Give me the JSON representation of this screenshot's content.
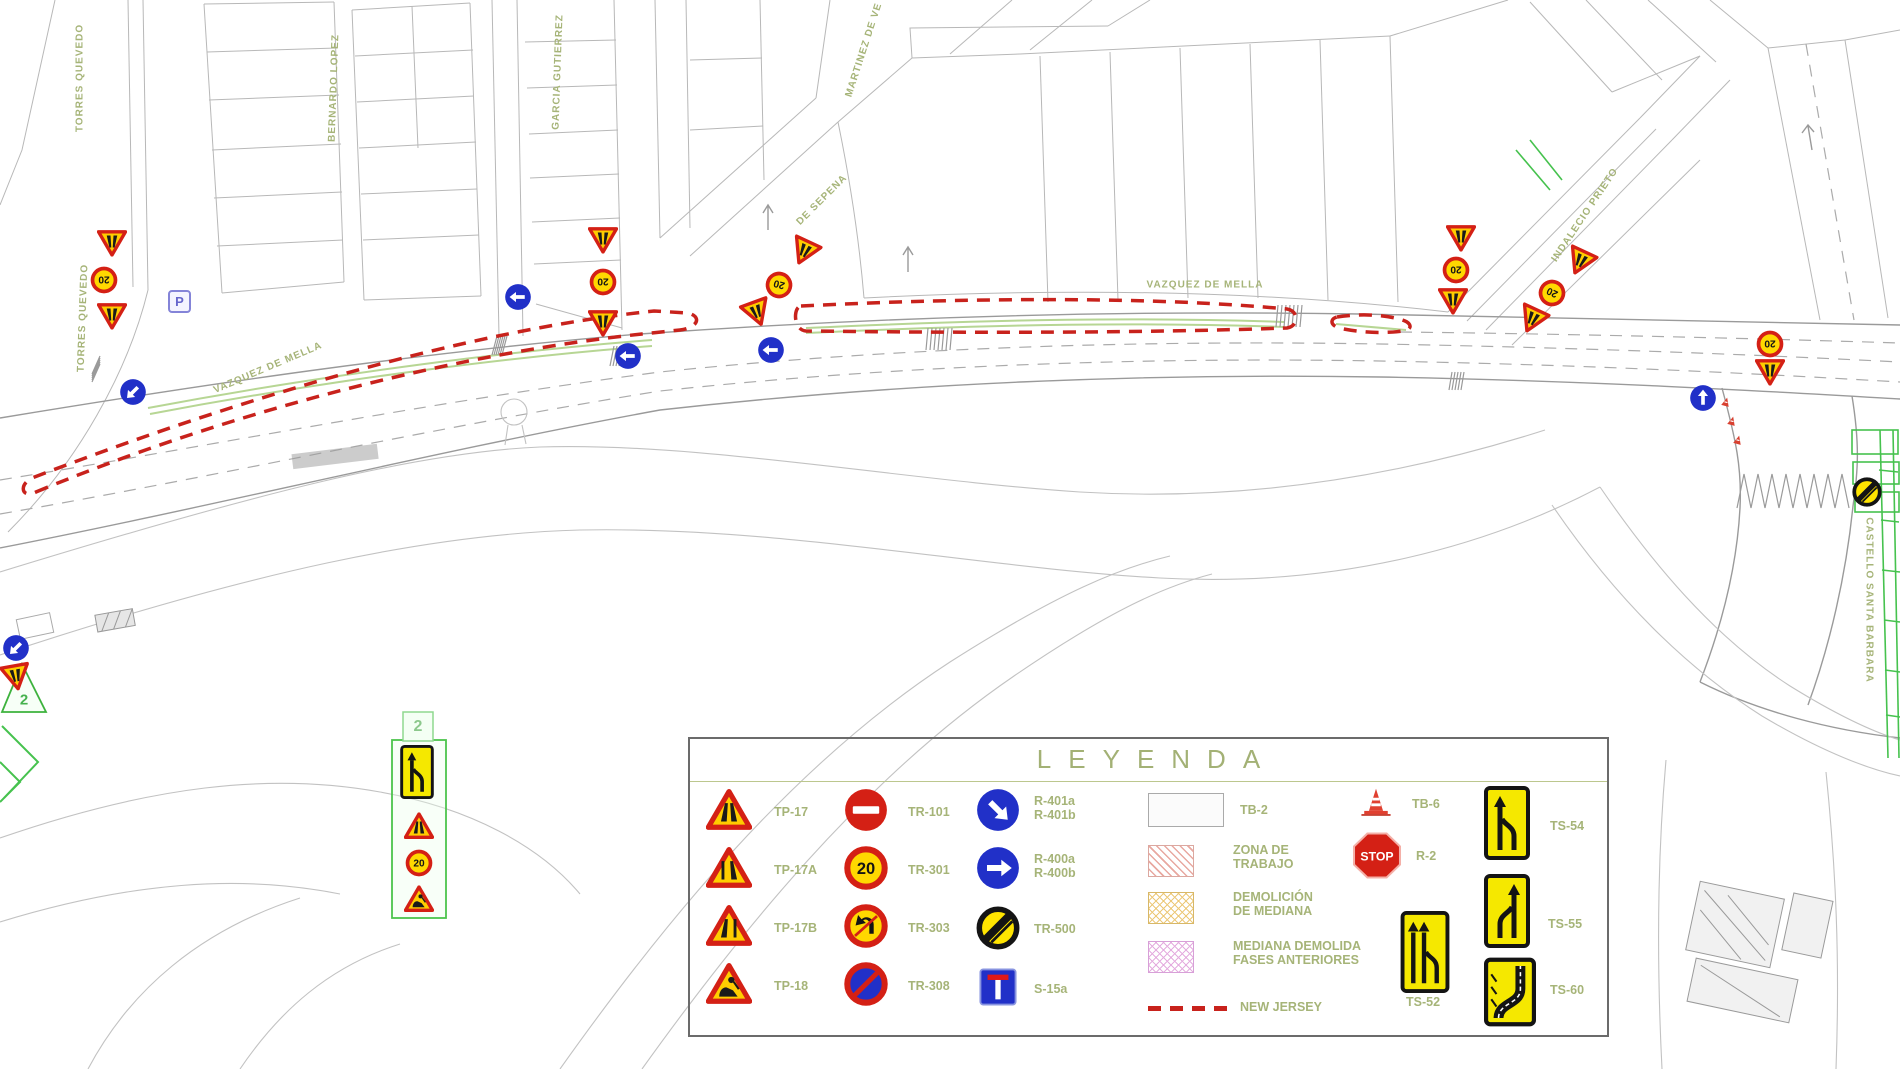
{
  "legend": {
    "title": "LEYENDA",
    "columns": {
      "warning": [
        {
          "label": "TP-17",
          "icon": "tp"
        },
        {
          "label": "TP-17A",
          "icon": "tp17a"
        },
        {
          "label": "TP-17B",
          "icon": "tp17b"
        },
        {
          "label": "TP-18",
          "icon": "tp18"
        }
      ],
      "prohibition": [
        {
          "label": "TR-101",
          "icon": "tr101"
        },
        {
          "label": "TR-301",
          "icon": "s20"
        },
        {
          "label": "TR-303",
          "icon": "tr303"
        },
        {
          "label": "TR-308",
          "icon": "tr308"
        }
      ],
      "obligation": [
        {
          "label_line1": "R-401a",
          "label_line2": "R-401b",
          "icon": "r401"
        },
        {
          "label_line1": "R-400a",
          "label_line2": "R-400b",
          "icon": "r400"
        },
        {
          "label": "TR-500",
          "icon": "endlimit"
        },
        {
          "label": "S-15a",
          "icon": "s15a"
        }
      ],
      "areas": [
        {
          "label": "TB-2",
          "swatch": "tb2"
        },
        {
          "label_line1": "ZONA DE",
          "label_line2": "TRABAJO",
          "swatch": "zona"
        },
        {
          "label_line1": "DEMOLICIÓN",
          "label_line2": "DE MEDIANA",
          "swatch": "demol"
        },
        {
          "label_line1": "MEDIANA DEMOLIDA",
          "label_line2": "FASES ANTERIORES",
          "swatch": "mediana"
        },
        {
          "label": "NEW JERSEY",
          "swatch": "nj"
        }
      ],
      "devices": [
        {
          "label": "TB-6",
          "icon": "tb6"
        },
        {
          "label": "R-2",
          "icon": "r2"
        },
        {
          "label": "TS-54",
          "icon": "ts54"
        },
        {
          "label": "TS-55",
          "icon": "ts55"
        },
        {
          "label": "TS-52",
          "icon": "ts52"
        },
        {
          "label": "TS-60",
          "icon": "ts60"
        }
      ]
    }
  },
  "map": {
    "parking_label": "P",
    "phase_labels": {
      "marker": "2",
      "panel": "2"
    },
    "street_labels": [
      {
        "text": "TORRES QUEVEDO",
        "x": 80,
        "y": 78,
        "rot": -90
      },
      {
        "text": "TORRES QUEVEDO",
        "x": 83,
        "y": 318,
        "rot": -88
      },
      {
        "text": "BERNARDO LOPEZ",
        "x": 334,
        "y": 88,
        "rot": -88
      },
      {
        "text": "GARCIA GUTIERREZ",
        "x": 558,
        "y": 72,
        "rot": -88
      },
      {
        "text": "MARTINEZ DE VE",
        "x": 864,
        "y": 50,
        "rot": -72
      },
      {
        "text": "DE SEPENA",
        "x": 822,
        "y": 200,
        "rot": -45
      },
      {
        "text": "VAZQUEZ DE MELLA",
        "x": 268,
        "y": 368,
        "rot": -23
      },
      {
        "text": "VAZQUEZ DE MELLA",
        "x": 1205,
        "y": 285,
        "rot": 0
      },
      {
        "text": "INDALECIO PRIETO",
        "x": 1585,
        "y": 215,
        "rot": -56
      },
      {
        "text": "CASTELLO SANTA BARBARA",
        "x": 1869,
        "y": 600,
        "rot": 90
      }
    ],
    "signs": [
      {
        "type": "tp",
        "x": 112,
        "y": 243,
        "rot": 180
      },
      {
        "type": "s20",
        "x": 104,
        "y": 280,
        "rot": 180
      },
      {
        "type": "tp",
        "x": 112,
        "y": 316,
        "rot": 180
      },
      {
        "type": "bluearrow",
        "x": 133,
        "y": 392,
        "rot": -135
      },
      {
        "type": "bluearrow",
        "x": 518,
        "y": 297,
        "rot": -90
      },
      {
        "type": "tp",
        "x": 603,
        "y": 240,
        "rot": 180
      },
      {
        "type": "s20",
        "x": 603,
        "y": 282,
        "rot": 180
      },
      {
        "type": "tp",
        "x": 603,
        "y": 323,
        "rot": 180
      },
      {
        "type": "bluearrow",
        "x": 628,
        "y": 356,
        "rot": -90
      },
      {
        "type": "tp",
        "x": 804,
        "y": 252,
        "rot": 205
      },
      {
        "type": "s20",
        "x": 779,
        "y": 285,
        "rot": 195
      },
      {
        "type": "tp",
        "x": 757,
        "y": 313,
        "rot": 160
      },
      {
        "type": "bluearrow",
        "x": 771,
        "y": 350,
        "rot": -90
      },
      {
        "type": "tp",
        "x": 1580,
        "y": 262,
        "rot": 205
      },
      {
        "type": "s20",
        "x": 1552,
        "y": 293,
        "rot": 205
      },
      {
        "type": "tp",
        "x": 1532,
        "y": 320,
        "rot": 205
      },
      {
        "type": "tp",
        "x": 1461,
        "y": 238,
        "rot": 180
      },
      {
        "type": "s20",
        "x": 1456,
        "y": 270,
        "rot": 180
      },
      {
        "type": "tp",
        "x": 1453,
        "y": 301,
        "rot": 180
      },
      {
        "type": "s20",
        "x": 1770,
        "y": 344,
        "rot": 180
      },
      {
        "type": "tp",
        "x": 1770,
        "y": 372,
        "rot": 180
      },
      {
        "type": "bluearrow",
        "x": 1703,
        "y": 398,
        "rot": 0
      },
      {
        "type": "minicone",
        "x": 1726,
        "y": 402,
        "rot": 15
      },
      {
        "type": "minicone",
        "x": 1732,
        "y": 421,
        "rot": 15
      },
      {
        "type": "minicone",
        "x": 1738,
        "y": 440,
        "rot": 15
      },
      {
        "type": "endlimit",
        "x": 1867,
        "y": 492,
        "rot": 0
      },
      {
        "type": "bluearrow",
        "x": 16,
        "y": 648,
        "rot": -135
      },
      {
        "type": "tp",
        "x": 16,
        "y": 677,
        "rot": 170
      },
      {
        "type": "ts54",
        "x": 417,
        "y": 772,
        "w": 44,
        "h": 54
      },
      {
        "type": "tp",
        "x": 419,
        "y": 826
      },
      {
        "type": "s20",
        "x": 419,
        "y": 863
      },
      {
        "type": "tp18",
        "x": 419,
        "y": 899
      }
    ]
  },
  "colors": {
    "legend_text": "#a6b478",
    "new_jersey_red": "#c8221c",
    "sign_red": "#d42015",
    "sign_yellow": "#ffd400",
    "sign_blue": "#2130c8",
    "works_green": "#46c24e"
  }
}
